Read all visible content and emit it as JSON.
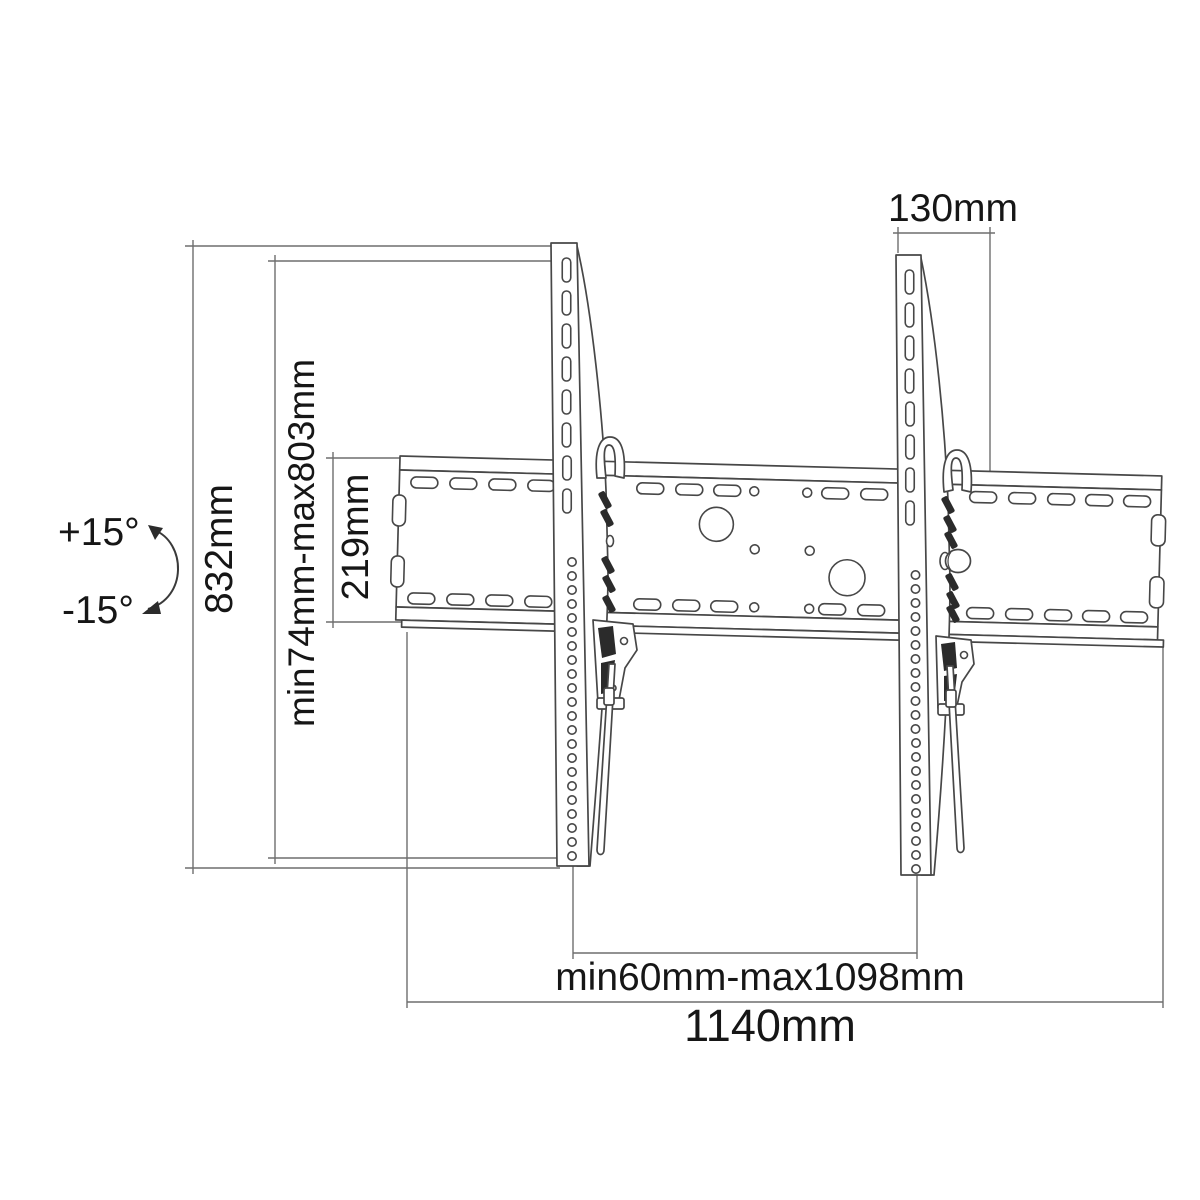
{
  "labels": {
    "bracket_width": "130mm",
    "total_height": "832mm",
    "height_range": "min74mm-max803mm",
    "plate_height": "219mm",
    "tilt_up": "+15°",
    "tilt_down": "-15°",
    "span_range": "min60mm-max1098mm",
    "total_width": "1140mm"
  },
  "colors": {
    "background": "#ffffff",
    "outline": "#474747",
    "dimension_line": "#6e6e6e",
    "text": "#161616",
    "detail_fill": "#2b2b2b"
  }
}
